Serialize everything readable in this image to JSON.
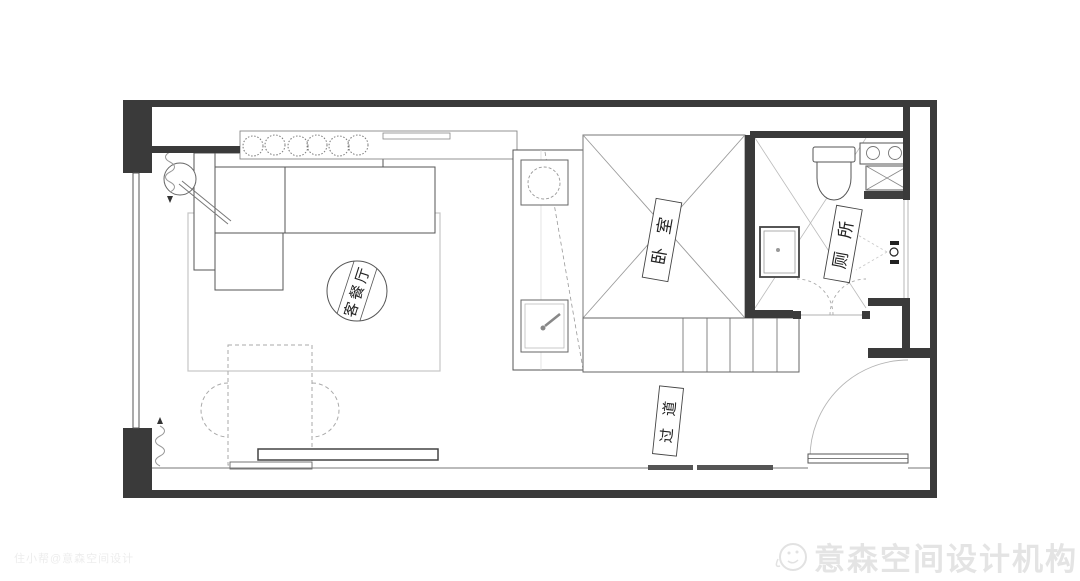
{
  "floorplan": {
    "type": "apartment-floor-plan",
    "rooms": [
      {
        "id": "living-dining",
        "label": "客餐厅"
      },
      {
        "id": "bedroom",
        "label": "卧室"
      },
      {
        "id": "toilet",
        "label": "厕所"
      },
      {
        "id": "corridor",
        "label": "过道"
      }
    ],
    "icons": [
      "plant-icon",
      "sofa-icon",
      "floor-lamp-icon",
      "curtain-icon",
      "fold-table-icon",
      "chair-icon",
      "tv-console-icon",
      "washing-machine-icon",
      "kitchen-sink-icon",
      "loft-bed-icon",
      "stairs-icon",
      "toilet-icon",
      "basin-vanity-icon",
      "shower-icon",
      "bathroom-sink-icon",
      "entry-door-icon",
      "folding-door-icon"
    ]
  },
  "watermarks": {
    "photo_credit": "住小帮@意森空间设计",
    "brand": "意森空间设计机构",
    "brand_logo": "smiley-face-logo"
  },
  "colors": {
    "wall": "#3a3a3a",
    "furniture_line": "#555555",
    "light_line": "#bbbbbb",
    "rug": "#c6c6c6",
    "label_text": "#222222",
    "watermark_brand": "#e4e4e4",
    "watermark_credit": "#ededed"
  }
}
